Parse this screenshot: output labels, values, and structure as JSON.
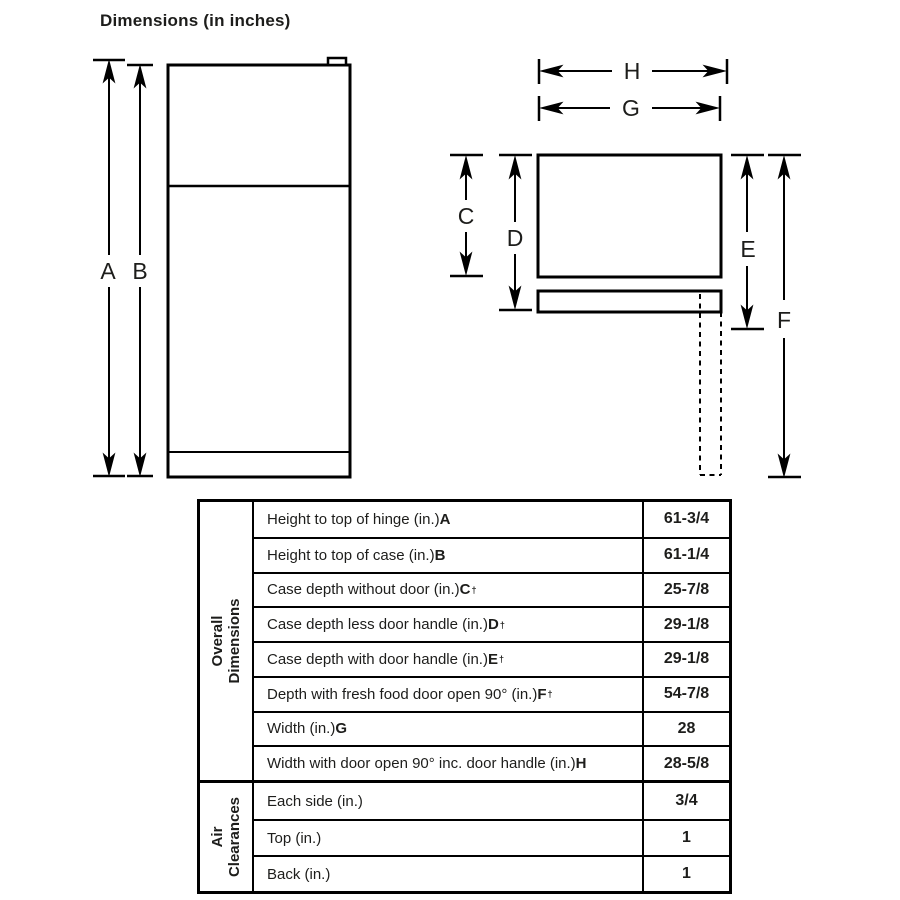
{
  "header": {
    "title": "Dimensions (in inches)"
  },
  "diagram": {
    "labels": {
      "a": "A",
      "b": "B",
      "c": "C",
      "d": "D",
      "e": "E",
      "f": "F",
      "g": "G",
      "h": "H"
    }
  },
  "table": {
    "groups": [
      {
        "label_lines": [
          "Overall",
          "Dimensions"
        ],
        "rows": [
          {
            "text": "Height to top of hinge (in.) ",
            "letter": "A",
            "dagger": "",
            "value": "61-3/4"
          },
          {
            "text": "Height to top of case (in.) ",
            "letter": "B",
            "dagger": "",
            "value": "61-1/4"
          },
          {
            "text": "Case depth without door (in.) ",
            "letter": "C",
            "dagger": "†",
            "value": "25-7/8"
          },
          {
            "text": "Case depth less door handle (in.) ",
            "letter": "D",
            "dagger": "†",
            "value": "29-1/8"
          },
          {
            "text": "Case depth with door handle (in.) ",
            "letter": "E",
            "dagger": "†",
            "value": "29-1/8"
          },
          {
            "text": "Depth with fresh food door open 90° (in.) ",
            "letter": "F",
            "dagger": "†",
            "value": "54-7/8"
          },
          {
            "text": "Width (in.) ",
            "letter": "G",
            "dagger": "",
            "value": "28"
          },
          {
            "text": "Width with door open 90° inc. door handle (in.) ",
            "letter": "H",
            "dagger": "",
            "value": "28-5/8"
          }
        ]
      },
      {
        "label_lines": [
          "Air",
          "Clearances"
        ],
        "rows": [
          {
            "text": "Each side (in.)",
            "letter": "",
            "dagger": "",
            "value": "3/4"
          },
          {
            "text": "Top (in.)",
            "letter": "",
            "dagger": "",
            "value": "1"
          },
          {
            "text": "Back (in.)",
            "letter": "",
            "dagger": "",
            "value": "1"
          }
        ]
      }
    ]
  }
}
